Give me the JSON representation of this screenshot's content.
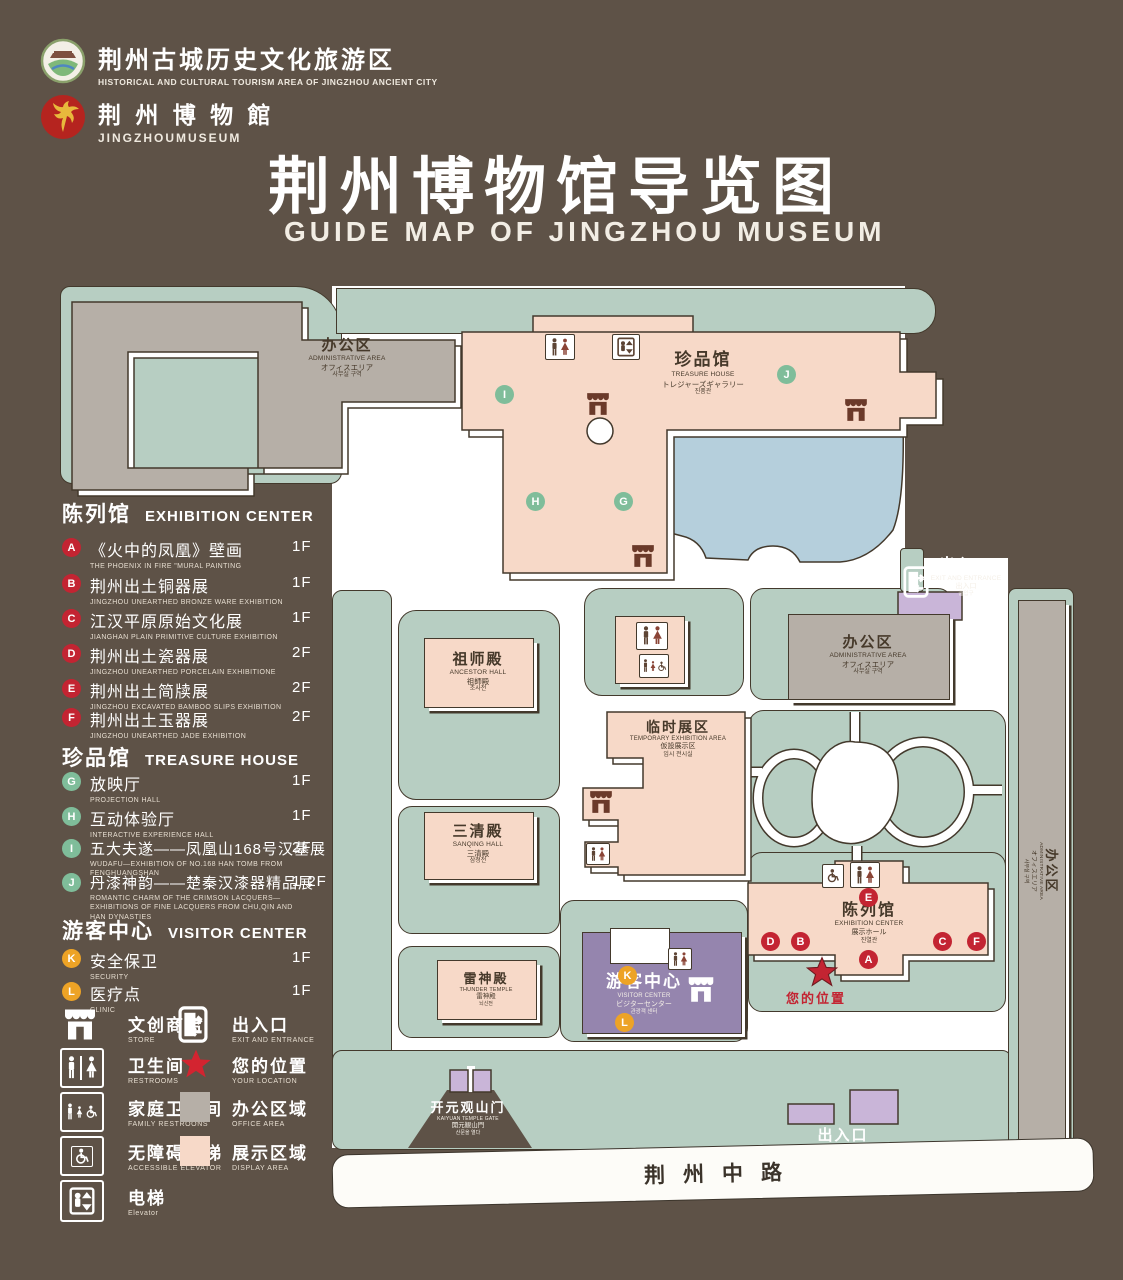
{
  "header": {
    "brand1": {
      "zh": "荆州古城历史文化旅游区",
      "en": "HISTORICAL AND CULTURAL TOURISM AREA OF JINGZHOU ANCIENT CITY"
    },
    "brand2": {
      "zh": "荆 州 博 物 館",
      "en": "JINGZHOUMUSEUM"
    },
    "title": "荆州博物馆导览图",
    "subtitle": "GUIDE MAP OF JINGZHOU MUSEUM"
  },
  "legend": {
    "sections": [
      {
        "title_zh": "陈列馆",
        "title_en": "EXHIBITION CENTER",
        "items": [
          {
            "key": "A",
            "zh": "《火中的凤凰》壁画",
            "en": "THE PHOENIX IN FIRE \"MURAL PAINTING",
            "floor": "1F"
          },
          {
            "key": "B",
            "zh": "荆州出土铜器展",
            "en": "JINGZHOU UNEARTHED BRONZE WARE EXHIBITION",
            "floor": "1F"
          },
          {
            "key": "C",
            "zh": "江汉平原原始文化展",
            "en": "JIANGHAN PLAIN PRIMITIVE CULTURE EXHIBITION",
            "floor": "1F"
          },
          {
            "key": "D",
            "zh": "荆州出土瓷器展",
            "en": "JINGZHOU UNEARTHED PORCELAIN EXHIBITIONE",
            "floor": "2F"
          },
          {
            "key": "E",
            "zh": "荆州出土简牍展",
            "en": "JINGZHOU EXCAVATED BAMBOO SLIPS EXHIBITION",
            "floor": "2F"
          },
          {
            "key": "F",
            "zh": "荆州出土玉器展",
            "en": "JINGZHOU UNEARTHED JADE EXHIBITION",
            "floor": "2F"
          }
        ]
      },
      {
        "title_zh": "珍品馆",
        "title_en": "TREASURE HOUSE",
        "items": [
          {
            "key": "G",
            "zh": "放映厅",
            "en": "PROJECTION HALL",
            "floor": "1F"
          },
          {
            "key": "H",
            "zh": "互动体验厅",
            "en": "INTERACTIVE EXPERIENCE HALL",
            "floor": "1F"
          },
          {
            "key": "I",
            "zh": "五大夫遂——凤凰山168号汉墓展",
            "en": "WUDAFU—EXHIBITION OF NO.168 HAN TOMB FROM FENGHUANGSHAN",
            "floor": "2F"
          },
          {
            "key": "J",
            "zh": "丹漆神韵——楚秦汉漆器精品展",
            "en": "ROMANTIC CHARM OF THE CRIMSON LACQUERS—EXHIBITIONS OF FINE LACQUERS FROM CHU,QIN AND HAN DYNASTIES",
            "floor": "1-2F"
          }
        ]
      },
      {
        "title_zh": "游客中心",
        "title_en": "VISITOR CENTER",
        "items": [
          {
            "key": "K",
            "zh": "安全保卫",
            "en": "SECURITY",
            "floor": "1F"
          },
          {
            "key": "L",
            "zh": "医疗点",
            "en": "CLINIC",
            "floor": "1F"
          }
        ]
      }
    ],
    "icons": {
      "store": {
        "zh": "文创商店",
        "en": "STORE"
      },
      "restrooms": {
        "zh": "卫生间",
        "en": "RESTROOMS"
      },
      "family": {
        "zh": "家庭卫生间",
        "en": "FAMILY RESTROONS"
      },
      "accessible": {
        "zh": "无障碍电梯",
        "en": "ACCESSIBLE ELEVATOR"
      },
      "elevator": {
        "zh": "电梯",
        "en": "Elevator"
      },
      "exit": {
        "zh": "出入口",
        "en": "EXIT AND ENTRANCE"
      },
      "location": {
        "zh": "您的位置",
        "en": "YOUR LOCATION"
      },
      "office": {
        "zh": "办公区域",
        "en": "OFFICE AREA"
      },
      "display": {
        "zh": "展示区域",
        "en": "DISPLAY AREA"
      }
    }
  },
  "map": {
    "buildings": {
      "admin_nw": {
        "zh": "办公区",
        "en": "ADMINISTRATIVE AREA",
        "jp": "オフィスエリア",
        "kr": "사무실 구역"
      },
      "treasure": {
        "zh": "珍品馆",
        "en": "TREASURE HOUSE",
        "jp": "トレジャーズギャラリー",
        "kr": "진품관"
      },
      "ancestor": {
        "zh": "祖师殿",
        "en": "ANCESTOR HALL",
        "jp": "祖師殿",
        "kr": "조사전"
      },
      "temp": {
        "zh": "临时展区",
        "en": "TEMPORARY EXHIBITION AREA",
        "jp": "仮設展示区",
        "kr": "임시 전시실"
      },
      "admin_e": {
        "zh": "办公区",
        "en": "ADMINISTRATIVE AREA",
        "jp": "オフィスエリア",
        "kr": "사무실 구역"
      },
      "admin_r": {
        "zh": "办公区",
        "en": "ADMINISTRATIVE AREA",
        "jp": "オフィスエリア",
        "kr": "사무실 구역"
      },
      "sanqing": {
        "zh": "三清殿",
        "en": "SANQING HALL",
        "jp": "三清殿",
        "kr": "삼청전"
      },
      "thunder": {
        "zh": "雷神殿",
        "en": "THUNDER TEMPLE",
        "jp": "雷神殿",
        "kr": "뇌신전"
      },
      "visitor": {
        "zh": "游客中心",
        "en": "VISITOR CENTER",
        "jp": "ビジターセンター",
        "kr": "관광객 센터"
      },
      "exhibition": {
        "zh": "陈列馆",
        "en": "EXHIBITION CENTER",
        "jp": "展示ホール",
        "kr": "진열관"
      },
      "gate": {
        "zh": "开元观山门",
        "en": "KAIYUAN TEMPLE GATE",
        "jp": "開元観山門",
        "kr": "산문을 열다"
      },
      "exit_top": {
        "zh": "出入口",
        "en": "EXIT AND ENTRANCE",
        "jp": "出入口",
        "kr": "출입구"
      },
      "exit_bottom": {
        "zh": "出入口",
        "en": "EXIT AND ENTRANCE",
        "jp": "出入口",
        "kr": "출입구"
      }
    },
    "markers": {
      "A": "A",
      "B": "B",
      "C": "C",
      "D": "D",
      "E": "E",
      "F": "F",
      "G": "G",
      "H": "H",
      "I": "I",
      "J": "J",
      "K": "K",
      "L": "L"
    },
    "your_location": "您的位置",
    "road": "荆州中路"
  },
  "colors": {
    "background": "#5e5247",
    "park_green": "#b7cec2",
    "display_pink": "#f7d9c8",
    "office_gray": "#b6afa7",
    "visitor_purple": "#9585ae",
    "pond_blue": "#b5cfdc",
    "marker_red": "#c32432",
    "marker_green": "#7fbd9a",
    "marker_orange": "#eda326",
    "gate_purple": "#c9b5d8"
  }
}
